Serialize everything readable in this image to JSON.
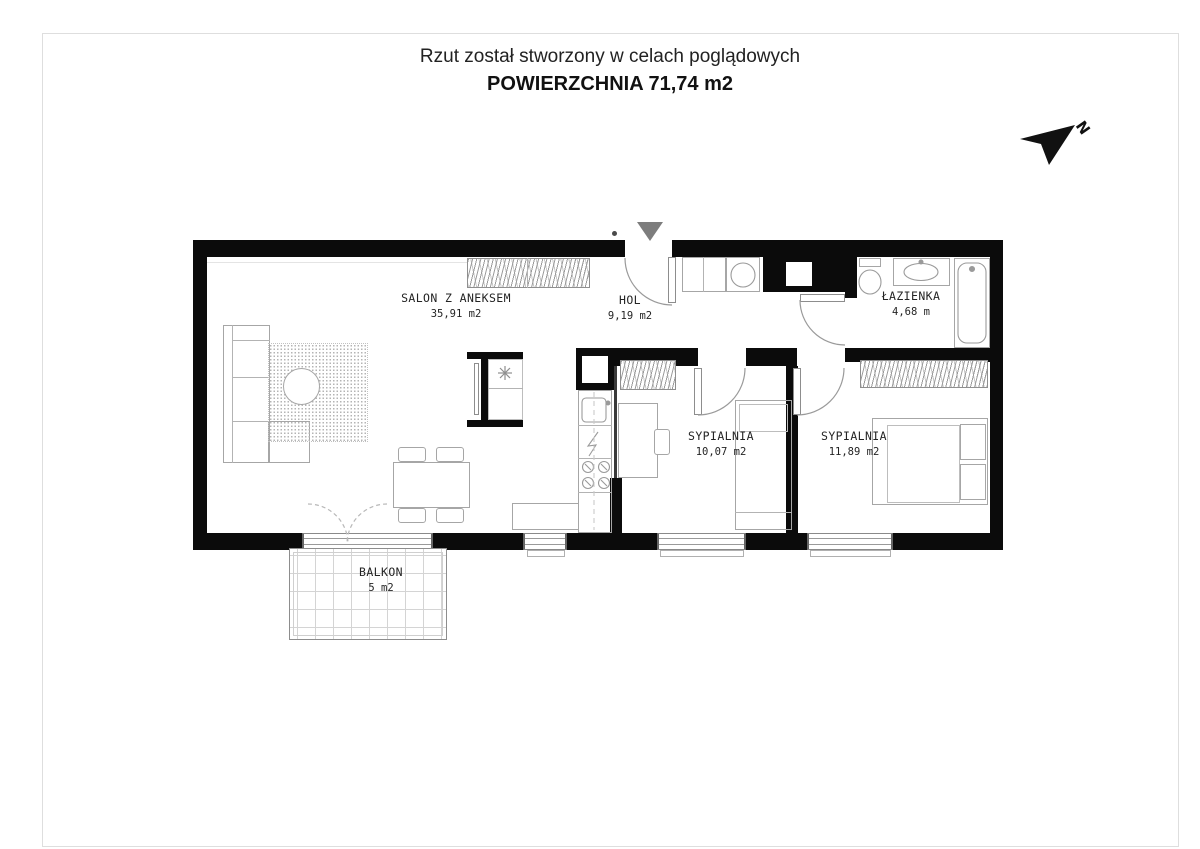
{
  "document": {
    "disclaimer": "Rzut został stworzony w celach poglądowych",
    "total_area": "POWIERZCHNIA 71,74 m2"
  },
  "compass": {
    "north_label": "N"
  },
  "rooms": [
    {
      "name": "SALON Z ANEKSEM",
      "area": "35,91 m2"
    },
    {
      "name": "HOL",
      "area": "9,19 m2"
    },
    {
      "name": "ŁAZIENKA",
      "area": "4,68 m"
    },
    {
      "name": "SYPIALNIA",
      "area": "10,07 m2"
    },
    {
      "name": "SYPIALNIA",
      "area": "11,89 m2"
    },
    {
      "name": "BALKON",
      "area": "5 m2"
    }
  ],
  "colors": {
    "wall": "#0b0b0b",
    "furniture_line": "#a6a6a6",
    "entrance_marker": "#7d7d7d",
    "page_border": "#dedede",
    "text": "#242424"
  }
}
